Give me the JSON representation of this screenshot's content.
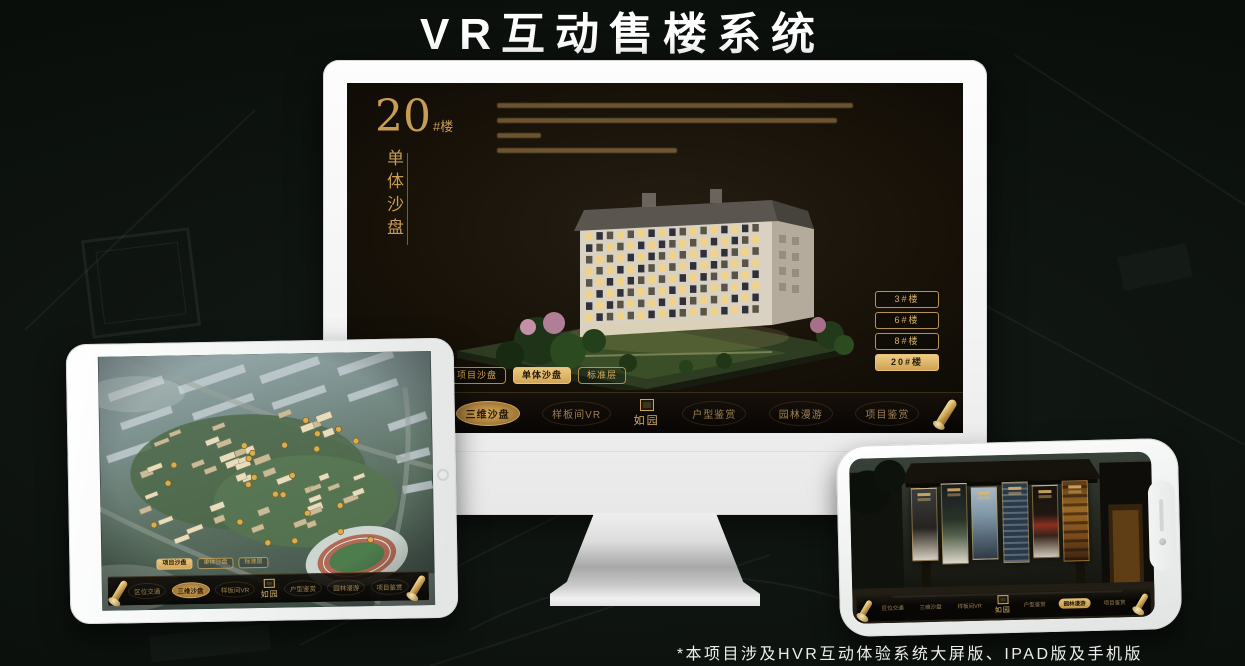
{
  "page": {
    "title": "VR互动售楼系统",
    "footnote": "*本项目涉及HVR互动体验系统大屏版、IPAD版及手机版"
  },
  "colors": {
    "gold": "#C9A25E",
    "gold_bright": "#ECC87E",
    "gold_fill": "#D2A558",
    "screen_bg": "#0C0906",
    "device_white": "#F4F5F5",
    "background": "#0C110D"
  },
  "monitor": {
    "heading": {
      "number": "20",
      "suffix": "#楼",
      "subtitle": "单体沙盘"
    },
    "building_buttons": [
      {
        "label": "3#楼",
        "active": false
      },
      {
        "label": "6#楼",
        "active": false
      },
      {
        "label": "8#楼",
        "active": false
      },
      {
        "label": "20#楼",
        "active": true
      }
    ],
    "sub_tabs": [
      {
        "label": "项目沙盘",
        "active": false
      },
      {
        "label": "单体沙盘",
        "active": true
      },
      {
        "label": "标准层",
        "active": false
      }
    ],
    "nav": {
      "logo": "如园",
      "items": [
        {
          "label": "区位交通",
          "active": false
        },
        {
          "label": "三维沙盘",
          "active": true
        },
        {
          "label": "样板间VR",
          "active": false
        },
        {
          "label": "户型鉴赏",
          "active": false
        },
        {
          "label": "园林漫游",
          "active": false
        },
        {
          "label": "项目鉴赏",
          "active": false
        }
      ]
    }
  },
  "tablet": {
    "sub_tabs": [
      {
        "label": "项目沙盘",
        "active": true
      },
      {
        "label": "单体沙盘",
        "active": false
      },
      {
        "label": "标准层",
        "active": false
      }
    ],
    "nav": {
      "logo": "如园",
      "items": [
        {
          "label": "区位交通",
          "active": false
        },
        {
          "label": "三维沙盘",
          "active": true
        },
        {
          "label": "样板间VR",
          "active": false
        },
        {
          "label": "户型鉴赏",
          "active": false
        },
        {
          "label": "园林漫游",
          "active": false
        },
        {
          "label": "项目鉴赏",
          "active": false
        }
      ]
    }
  },
  "phone": {
    "nav": {
      "logo": "如园",
      "items": [
        {
          "label": "区位交通",
          "active": false
        },
        {
          "label": "三维沙盘",
          "active": false
        },
        {
          "label": "样板间VR",
          "active": false
        },
        {
          "label": "户型鉴赏",
          "active": false
        },
        {
          "label": "园林漫游",
          "active": true
        },
        {
          "label": "项目鉴赏",
          "active": false
        }
      ]
    }
  }
}
